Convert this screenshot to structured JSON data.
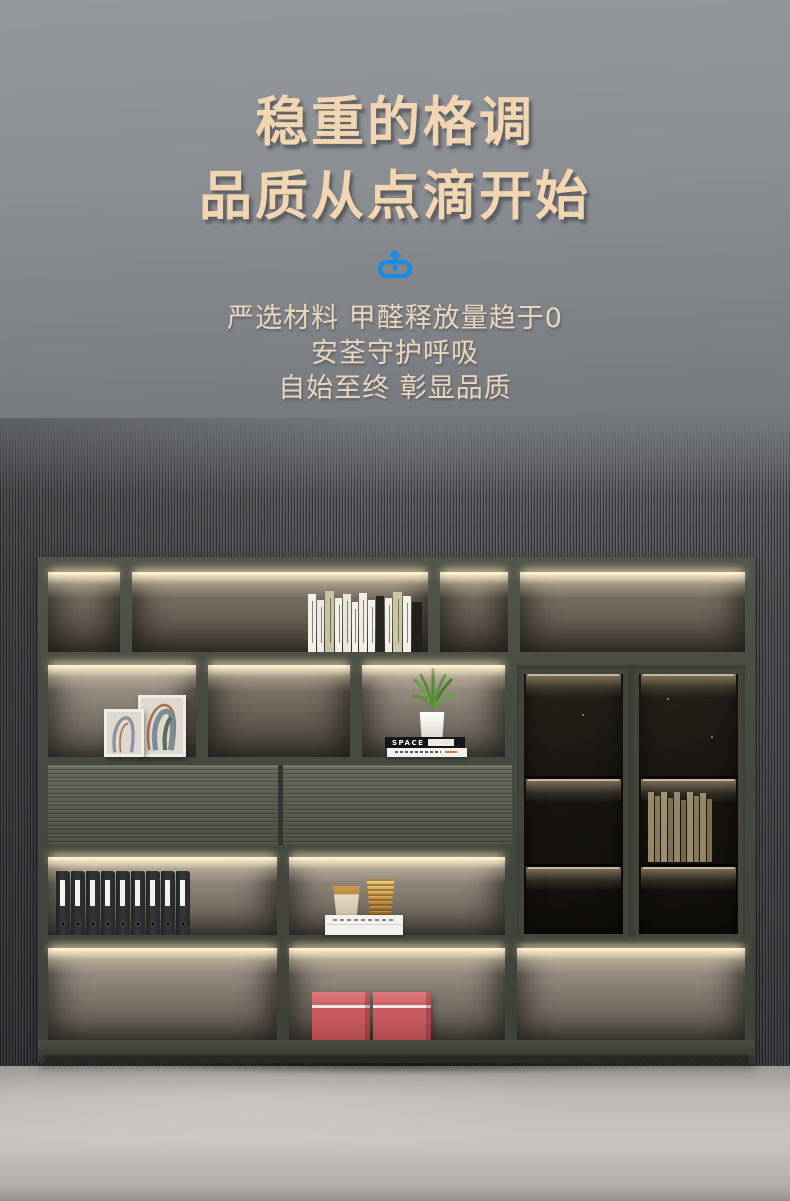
{
  "hero": {
    "title_line1": "稳重的格调",
    "title_line2": "品质从点滴开始",
    "sub_lines": [
      "严选材料 甲醛释放量趋于0",
      "安荃守护呼吸",
      "自始至终 彰显品质"
    ]
  },
  "brand_icon": {
    "name": "power-arrow-icon",
    "color": "#1b8ce0"
  },
  "colors": {
    "heading": "#f2d6b2",
    "subtext": "#e9d7bd",
    "accent_blue": "#1b8ce0",
    "frame": "#474b41",
    "glow": "#ffeecd",
    "box_red": "#cb5d63",
    "gold": "#c59545",
    "binder_black": "#2a2c2d",
    "wall_gray": "#8b8e92",
    "floor_gray": "#c9c6c1"
  },
  "decor": {
    "space_book": {
      "label": "SPACE"
    },
    "top_books": {
      "count": 13,
      "spines": [
        {
          "c": "#f1efe8",
          "w": 8,
          "h": 58
        },
        {
          "c": "#eceae2",
          "w": 7,
          "h": 52
        },
        {
          "c": "#c7c3a2",
          "w": 9,
          "h": 61
        },
        {
          "c": "#f3f1ea",
          "w": 7,
          "h": 54
        },
        {
          "c": "#e9e4d8",
          "w": 8,
          "h": 58
        },
        {
          "c": "#f1efe8",
          "w": 6,
          "h": 50
        },
        {
          "c": "#efede6",
          "w": 8,
          "h": 59
        },
        {
          "c": "#f4f2ec",
          "w": 7,
          "h": 52
        },
        {
          "c": "#262624",
          "w": 8,
          "h": 56
        },
        {
          "c": "#f0eee7",
          "w": 7,
          "h": 54
        },
        {
          "c": "#cbc7a6",
          "w": 9,
          "h": 60
        },
        {
          "c": "#f2f0e9",
          "w": 8,
          "h": 56
        },
        {
          "c": "#201f1c",
          "w": 10,
          "h": 50
        }
      ]
    },
    "glass_books": {
      "count": 10,
      "spines": [
        {
          "c": "#b8a77e",
          "w": 6,
          "h": 70
        },
        {
          "c": "#a6956c",
          "w": 5,
          "h": 66
        },
        {
          "c": "#c0af86",
          "w": 6,
          "h": 70
        },
        {
          "c": "#998861",
          "w": 5,
          "h": 64
        },
        {
          "c": "#b3a279",
          "w": 6,
          "h": 70
        },
        {
          "c": "#8d7c57",
          "w": 5,
          "h": 62
        },
        {
          "c": "#bcab82",
          "w": 6,
          "h": 70
        },
        {
          "c": "#a1906a",
          "w": 5,
          "h": 66
        },
        {
          "c": "#b5a47b",
          "w": 6,
          "h": 69
        },
        {
          "c": "#97865f",
          "w": 5,
          "h": 63
        }
      ]
    },
    "binders": {
      "count": 9,
      "items": [
        {},
        {},
        {},
        {},
        {},
        {},
        {},
        {},
        {}
      ]
    }
  }
}
